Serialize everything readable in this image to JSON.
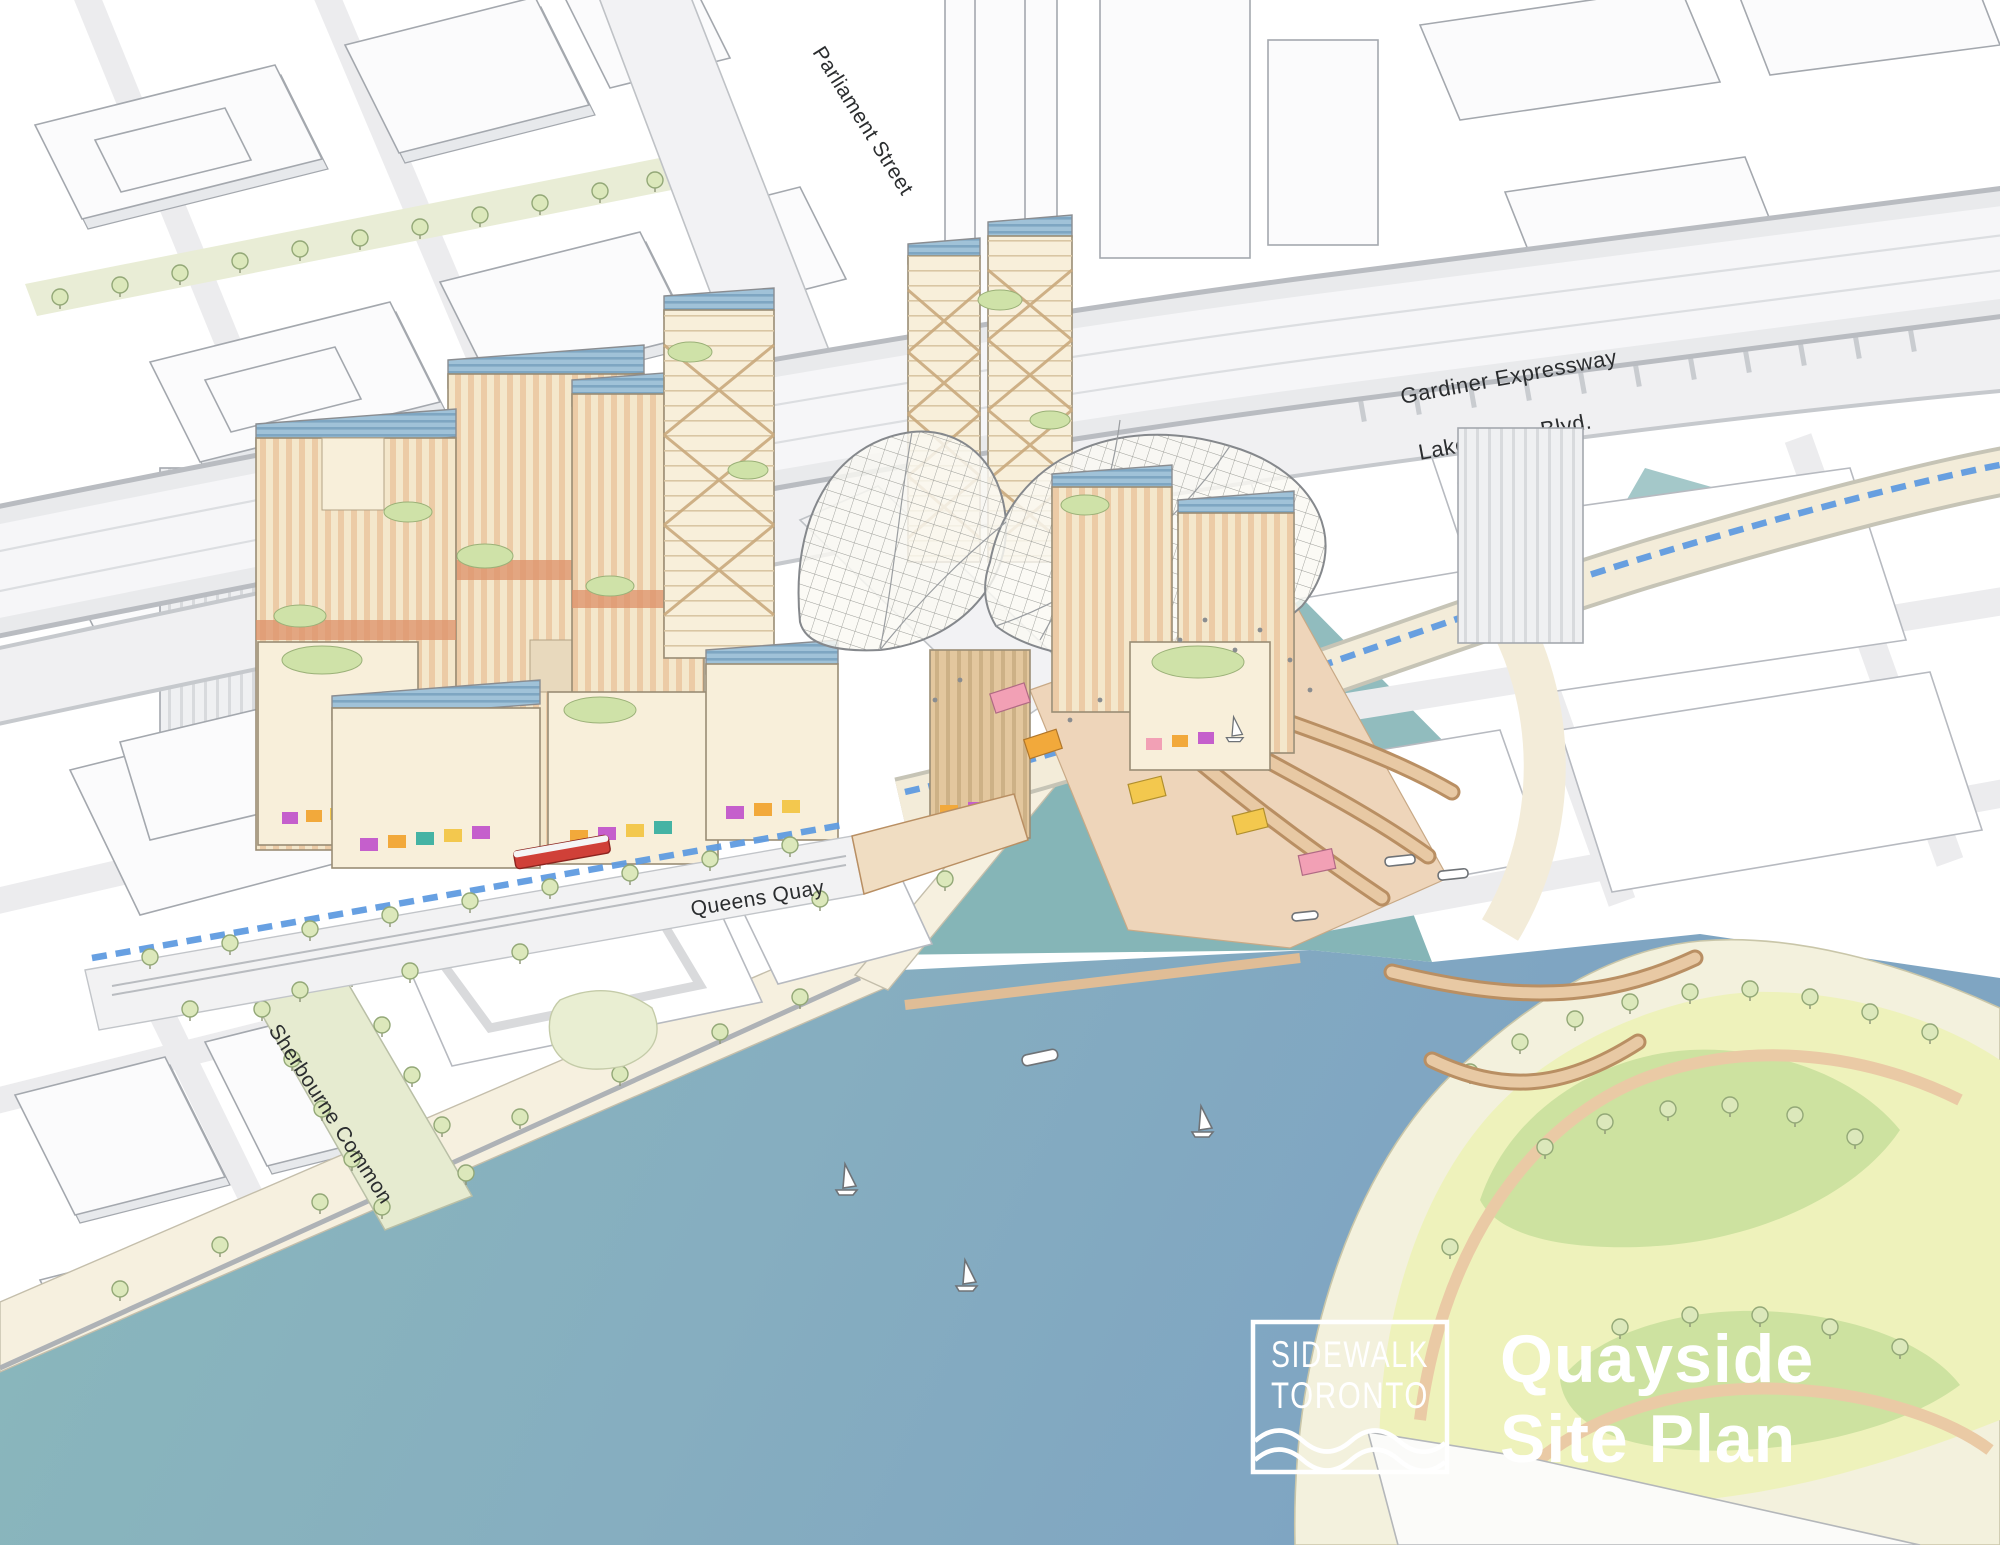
{
  "page_title": "Quayside Site Plan",
  "title": {
    "line1": "Quayside",
    "line2": "Site Plan"
  },
  "logo": {
    "line1": "SIDEWALK",
    "line2": "TORONTO",
    "mark": "wave-lines-icon"
  },
  "street_labels": {
    "parliament": "Parliament Street",
    "gardiner": "Gardiner Expressway",
    "lake_shore": "Lake Shore Blvd.",
    "queens_quay": "Queens Quay",
    "sherbourne_common": "Sherbourne Common"
  },
  "colors": {
    "water_blue": "#7fa5c2",
    "water_teal": "#8ab8bb",
    "slip_teal": "#85b5b7",
    "shore_sand": "#f6f0df",
    "park_base": "#f3f1dd",
    "park_light": "#eef2bb",
    "park_green": "#cde2a0",
    "path_tan": "#eacaa5",
    "city_fill": "#fbfbfc",
    "city_line": "#a4a8ae",
    "street_grey": "#ececee",
    "gardiner_grey": "#e9eaec",
    "band_edge": "#b9bcc1",
    "cream": "#f4e7cb",
    "cream_light": "#f8efda",
    "peach_stripe": "#eccba6",
    "terracotta": "#dd9068",
    "roof_blue": "#a0c2d8",
    "roof_slat": "#7ea6c2",
    "timber": "#c9a87c",
    "tan_ribbed": "#e3c79e",
    "plaza_tan": "#eed5ba",
    "boardwalk": "#e8c9a4",
    "boardwalk_edge": "#b98f63",
    "tree_fill": "#dce8bb",
    "tree_line": "#93a877",
    "green_roof": "#cfe2a8",
    "bike_blue": "#5f9be0",
    "streetcar_red": "#d04038",
    "chip_magenta": "#c55fcc",
    "chip_orange": "#f2a93b",
    "chip_teal": "#45b3a4",
    "chip_yellow": "#f3c84e",
    "chip_pink": "#f2a0b5",
    "label_dark": "#2b2d2f",
    "text_white": "#ffffff",
    "green_street": "#e9edd6",
    "common_green": "#e6ebd0"
  }
}
